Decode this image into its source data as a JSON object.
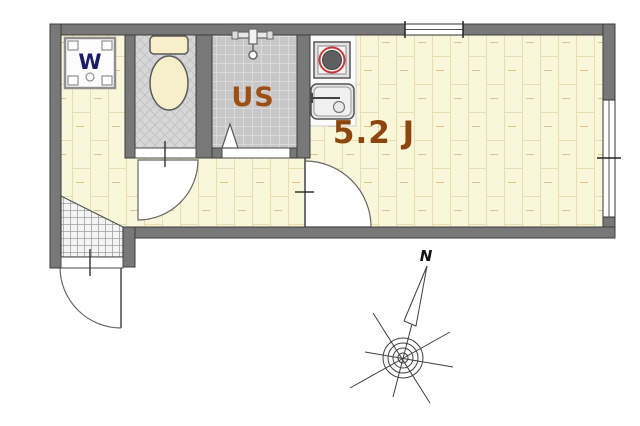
{
  "labels": {
    "main_room": "5.2 J",
    "bathroom": "US",
    "washer": "W",
    "compass_north": "N"
  },
  "colors": {
    "wall": "#787878",
    "wood_floor": "#faf6d9",
    "main_room_label": "#8d450e",
    "bathroom_label": "#9e5014",
    "washer_label": "#1b1b66",
    "burner_ring": "#c23b3b"
  },
  "fixtures": [
    "washing-machine",
    "toilet",
    "shower-mixer",
    "stove-burner",
    "kitchen-sink"
  ],
  "features": [
    "entrance-door",
    "toilet-door",
    "bathroom-folding-door",
    "main-room-door",
    "top-window",
    "right-window",
    "compass-rose"
  ]
}
